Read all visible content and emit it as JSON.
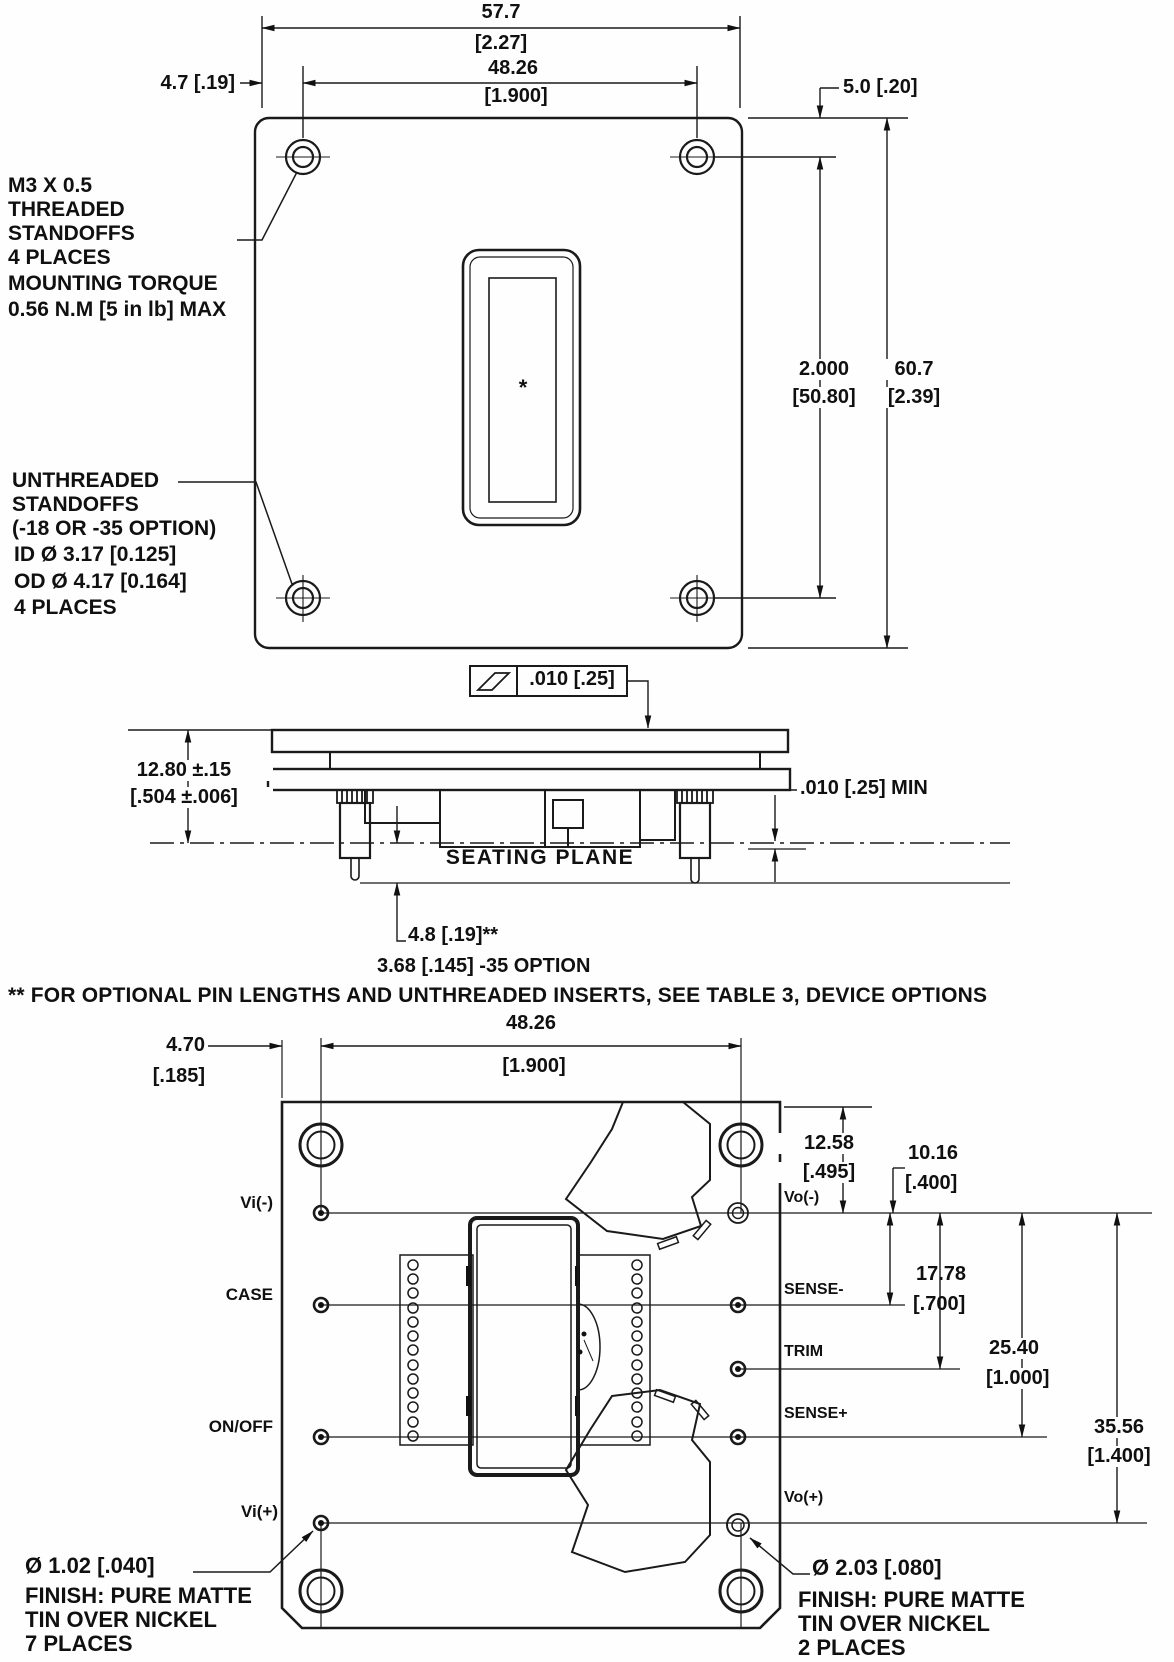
{
  "top_view": {
    "dim_width_mm": "57.7",
    "dim_width_in": "[2.27]",
    "dim_pitch_mm": "48.26",
    "dim_pitch_in": "[1.900]",
    "dim_edge": "4.7 [.19]",
    "dim_top": "5.0 [.20]",
    "dim_vpitch_in": "2.000",
    "dim_vpitch_mm": "[50.80]",
    "dim_height_mm": "60.7",
    "dim_height_in": "[2.39]",
    "note_threaded": {
      "l1": "M3 X 0.5",
      "l2": "THREADED",
      "l3": "STANDOFFS",
      "l4": "4 PLACES",
      "l5": "MOUNTING TORQUE",
      "l6": "0.56 N.M [5 in lb] MAX"
    },
    "note_unthreaded": {
      "l1": "UNTHREADED",
      "l2": "STANDOFFS",
      "l3": "(-18 OR -35 OPTION)",
      "l4": "ID Ø 3.17 [0.125]",
      "l5": "OD Ø 4.17 [0.164]",
      "l6": "4 PLACES"
    },
    "label_mark": "*"
  },
  "side_view": {
    "flatness": ".010  [.25]",
    "height_mm": "12.80 ±.15",
    "height_in": "[.504 ±.006]",
    "clearance": ".010 [.25] MIN",
    "seating_plane": "SEATING  PLANE",
    "pin_length": "4.8 [.19]**",
    "pin_length_option": "3.68 [.145] -35 OPTION"
  },
  "footnote": "** FOR OPTIONAL PIN LENGTHS AND UNTHREADED INSERTS, SEE TABLE 3, DEVICE OPTIONS",
  "bottom_view": {
    "dim_edge_mm": "4.70",
    "dim_edge_in": "[.185]",
    "dim_pitch_mm": "48.26",
    "dim_pitch_in": "[1.900]",
    "dim_a_mm": "12.58",
    "dim_a_in": "[.495]",
    "dim_b_mm": "10.16",
    "dim_b_in": "[.400]",
    "dim_c_mm": "17.78",
    "dim_c_in": "[.700]",
    "dim_d_mm": "25.40",
    "dim_d_in": "[1.000]",
    "dim_e_mm": "35.56",
    "dim_e_in": "[1.400]",
    "pins_left": {
      "vi_neg": "Vi(-)",
      "case": "CASE",
      "on_off": "ON/OFF",
      "vi_pos": "Vi(+)"
    },
    "pins_right": {
      "vo_neg": "Vo(-)",
      "sense_neg": "SENSE-",
      "trim": "TRIM",
      "sense_pos": "SENSE+",
      "vo_pos": "Vo(+)"
    },
    "callout_input_pins": {
      "l1": "Ø 1.02 [.040]",
      "l2": "FINISH: PURE MATTE",
      "l3": "TIN OVER NICKEL",
      "l4": "7 PLACES"
    },
    "callout_output_pins": {
      "l1": "Ø 2.03 [.080]",
      "l2": "FINISH: PURE MATTE",
      "l3": "TIN OVER NICKEL",
      "l4": "2 PLACES"
    }
  }
}
